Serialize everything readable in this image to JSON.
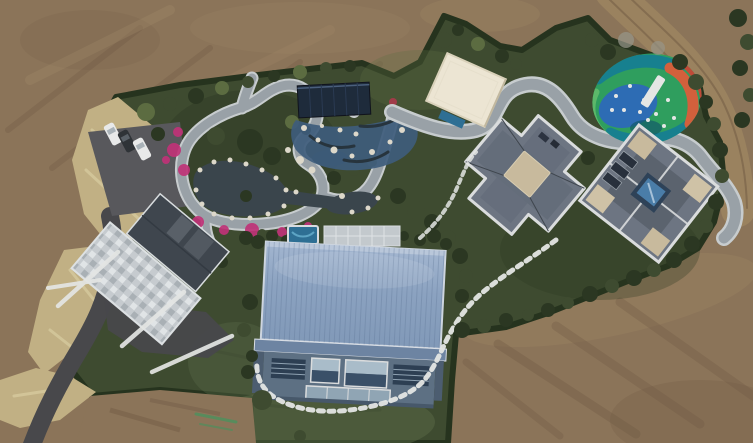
{
  "image": {
    "kind": "aerial-drone-photograph",
    "description": "Top-down aerial drone view of a landscaped private estate surrounded by bare brown earth: an ornamental garden with a dark pond, winding light stone paths and pink azalea beds; a rock-lined blue pool deck with a dark pool pavilion; a cream flat-roofed building; a circular children's playground painted in green, blue, teal and orange swirls; two grey hip-roofed mansions; a stone-tiled house with grey gable roof at the west; a large hall with a pale blue standing-seam metal roof and glass facade at the south; a curved white stepping-stone path across the lawn; an asphalt driveway leading to a parking pad with two white cars and one dark car; a dirt road curving along the top right."
  },
  "scene": {
    "features": [
      {
        "id": "bare-earth",
        "label": "bare earth construction ground"
      },
      {
        "id": "dirt-road",
        "label": "curving dirt road (top right)"
      },
      {
        "id": "hedge-boundary",
        "label": "dark evergreen hedge boundary"
      },
      {
        "id": "ornamental-garden",
        "label": "ornamental garden with pond"
      },
      {
        "id": "garden-paths",
        "label": "winding light stone garden paths"
      },
      {
        "id": "azalea-beds",
        "label": "pink azalea flower beds"
      },
      {
        "id": "pool-deck",
        "label": "blue tiled pool deck with white rocks"
      },
      {
        "id": "pool-pavilion",
        "label": "dark navy pool pavilion roof"
      },
      {
        "id": "cream-building",
        "label": "cream flat-roofed building"
      },
      {
        "id": "playground",
        "label": "painted children's playground"
      },
      {
        "id": "mansion-middle",
        "label": "grey hip-roof mansion (center)"
      },
      {
        "id": "mansion-east",
        "label": "grey hip-roof mansion with courtyard pool (east)"
      },
      {
        "id": "stone-house-west",
        "label": "stone-terraced house with grey gable roof (west)"
      },
      {
        "id": "blue-roof-hall",
        "label": "large hall with pale blue metal roof"
      },
      {
        "id": "terrace-pool",
        "label": "small teal spa pool on terrace"
      },
      {
        "id": "stepping-path",
        "label": "white stepping-stone path"
      },
      {
        "id": "lawn",
        "label": "green lawn"
      },
      {
        "id": "driveway",
        "label": "asphalt driveway"
      },
      {
        "id": "parking",
        "label": "parking pad with three cars"
      },
      {
        "id": "cars",
        "label": "two white cars, one dark car"
      },
      {
        "id": "dry-grass",
        "label": "dry tan grass verge"
      }
    ],
    "counts": {
      "cars_white": 2,
      "cars_dark": 1,
      "buildings": 5
    }
  },
  "palette": {
    "dirt": "#8b7459",
    "dirt-dark": "#6e5742",
    "dirt-light": "#a28a69",
    "road-dirt": "#9a825f",
    "hedge": "#26331e",
    "foliage": "#3e4b30",
    "foliage-light": "#5c6c41",
    "shrub-dark": "#2b3722",
    "lawn-light": "#5d6d4a",
    "dry-grass": "#c1b084",
    "dry-grass-light": "#d6c99e",
    "asphalt": "#48484b",
    "asphalt-light": "#58585c",
    "path-gray": "#99a1a7",
    "path-light": "#c7ccce",
    "stone-white": "#ddd8ca",
    "pond": "#3a454c",
    "pool-blue": "#3e5c7c",
    "pool-navy": "#1e2b3b",
    "pool-teal": "#2e6f94",
    "flower-pink": "#c03378",
    "cream-roof": "#ece5d3",
    "slate-roof": "#6d7582",
    "slate-dark": "#515861",
    "slate-deep": "#3f464e",
    "roof-trim": "#dadcdd",
    "tan-patch": "#c8ba9d",
    "blue-roof": "#8199b8",
    "blue-roof-light": "#a3b6d0",
    "blue-roof-dark": "#6d84a2",
    "facade": "#5d7083",
    "window-dark": "#2d3f53",
    "glass": "#a9bcc9",
    "play-green": "#2f9e5e",
    "play-teal": "#17808f",
    "play-blue": "#2d6cb4",
    "play-orange": "#d2603c",
    "play-red": "#bf4a38",
    "play-green-light": "#5cb86a",
    "car-white": "#e8e9e9",
    "car-dark": "#2f3337",
    "white": "#e4e6e4",
    "court-blue": "#4a7da8",
    "court-dark": "#2e4258",
    "bare-tree": "#97978a"
  }
}
